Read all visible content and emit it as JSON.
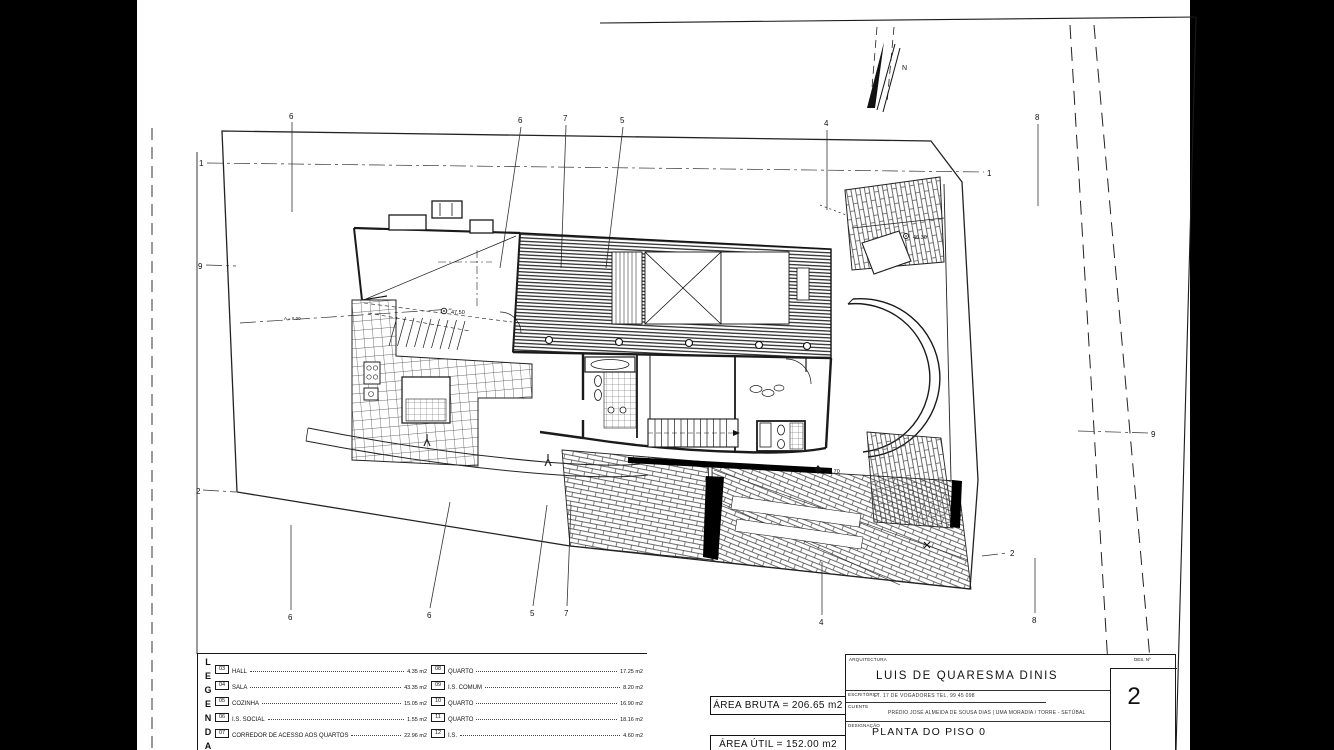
{
  "window": {
    "width": 1334,
    "height": 750
  },
  "colors": {
    "paper": "#ffffff",
    "ink": "#111111",
    "side_bars": "#000000"
  },
  "plan": {
    "north_label": "N",
    "markers": {
      "top": [
        "6",
        "6",
        "7",
        "5",
        "4",
        "8"
      ],
      "bottom": [
        "6",
        "6",
        "5",
        "7",
        "4",
        "8"
      ],
      "left": [
        "1",
        "9",
        "2"
      ],
      "right": [
        "1",
        "9",
        "2"
      ]
    },
    "levels": [
      "47.50",
      "45.70",
      "46.30"
    ],
    "aux_label": "A = 6.00"
  },
  "legend": {
    "title": "LEGENDA",
    "col1": [
      {
        "num": "03",
        "label": "HALL",
        "area": "4.35 m2"
      },
      {
        "num": "04",
        "label": "SALA",
        "area": "43.35 m2"
      },
      {
        "num": "05",
        "label": "COZINHA",
        "area": "15.05 m2"
      },
      {
        "num": "06",
        "label": "I.S. SOCIAL",
        "area": "1.55 m2"
      },
      {
        "num": "07",
        "label": "CORREDOR DE ACESSO AOS QUARTOS",
        "area": "22.96 m2"
      }
    ],
    "col2": [
      {
        "num": "08",
        "label": "QUARTO",
        "area": "17.25 m2"
      },
      {
        "num": "09",
        "label": "I.S. COMUM",
        "area": "8.20 m2"
      },
      {
        "num": "10",
        "label": "QUARTO",
        "area": "16.90 m2"
      },
      {
        "num": "11",
        "label": "QUARTO",
        "area": "18.16 m2"
      },
      {
        "num": "12",
        "label": "I.S.",
        "area": "4.60 m2"
      }
    ],
    "area_bruta": "ÁREA BRUTA = 206.65 m2",
    "area_util": "ÁREA ÚTIL = 152.00 m2"
  },
  "title_block": {
    "discipline_label": "ARQUITECTURA",
    "architect": "LUIS DE QUARESMA DINIS",
    "office_label": "ESCRITÓRIO",
    "office_text": "LT. 17 DE VOGADORES   TEL. 99 45 098",
    "client_label": "CLIENTE",
    "project_text": "PRÉDIO JOSÉ ALMEIDA DE SOUSA DIAS | UMA MORADIA / TORRE - SETÚBAL",
    "designation_label": "DESIGNAÇÃO",
    "drawing_title": "PLANTA DO PISO 0",
    "sheet_label": "DES. Nº",
    "sheet_number": "2"
  }
}
